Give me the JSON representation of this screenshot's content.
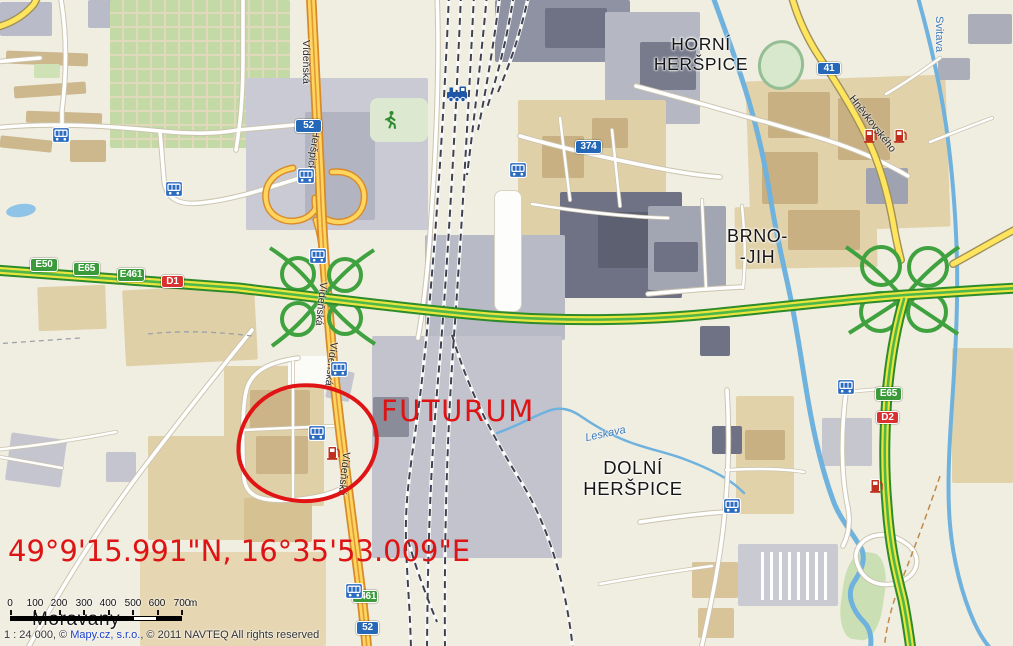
{
  "annotations": {
    "poi_label": "FUTURUM",
    "coordinates_label": "49°9'15.991\"N, 16°35'53.009\"E",
    "color": "#de1414"
  },
  "places": {
    "horni_herspice": "HORNÍ\nHERŠPICE",
    "brno_jih": "BRNO-\n-JIH",
    "dolni_herspice": "DOLNÍ\nHERŠPICE",
    "moravany": "Moravany"
  },
  "streets": {
    "videnska_top": "Vídeňská",
    "herspicka": "Heršpická",
    "videnska_mid_upper": "Vídeňská",
    "videnska_mid_lower": "Vídeňská",
    "videnska_south": "Vídeňská",
    "hnevkovskeho": "Hněvkovského"
  },
  "waterways": {
    "svitava": "Svitava",
    "leskava": "Leskava"
  },
  "shields": {
    "e50": "E50",
    "e65_west": "E65",
    "e461_west": "E461",
    "d1": "D1",
    "r52_north": "52",
    "r374": "374",
    "r41": "41",
    "e65_east": "E65",
    "d2": "D2",
    "e461_south": "E461",
    "r52_south": "52"
  },
  "icons": {
    "tram_stop": "tram-stop",
    "train_station": "train-station",
    "fuel_station": "fuel-station",
    "sports": "runner"
  },
  "scale_bar": {
    "ticks": [
      "0",
      "100",
      "200",
      "300",
      "400",
      "500",
      "600",
      "700"
    ],
    "unit": "m"
  },
  "attribution": {
    "scale_text": "1 : 24 000, © ",
    "link_text": "Mapy.cz, s.r.o.",
    "rest_text": ", © 2011 NAVTEQ All rights reserved"
  },
  "colors": {
    "annotation_red": "#de1414",
    "motorway_green": "#3fa23f",
    "road_orange": "#e09a38",
    "road_yellow": "#ffe45e",
    "water_blue": "#6fb2de",
    "shield_blue": "#2668b8",
    "shield_green": "#3b9b3b",
    "shield_red": "#d93030"
  }
}
